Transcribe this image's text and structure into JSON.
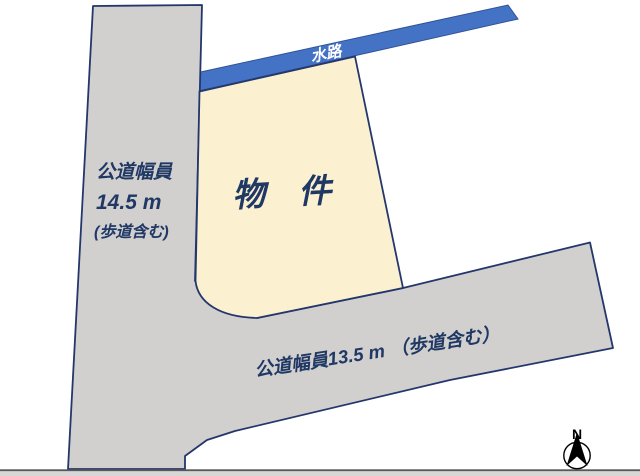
{
  "diagram": {
    "title_hint": "land-plot-diagram",
    "parcel_label": "物　件",
    "waterway_label": "水路",
    "left_road": {
      "line1": "公道幅員",
      "line2": "14.5 m",
      "line3": "(歩道含む)"
    },
    "bottom_road_label": "公道幅員13.5 m （歩道含む）",
    "compass": {
      "north_label": "N"
    }
  },
  "colors": {
    "background": "#ffffff",
    "road_fill": "#d2cfcf",
    "road_border": "#24376c",
    "parcel_fill": "#fbf0d0",
    "parcel_border": "#24376c",
    "waterway_fill": "#4472c4",
    "waterway_border": "#2f5597",
    "label_navy": "#1f3864",
    "waterway_label_color": "#ffffff",
    "compass_color": "#000000",
    "bottom_line": "#59585a",
    "bottom_strip": "#d9d7d6"
  }
}
